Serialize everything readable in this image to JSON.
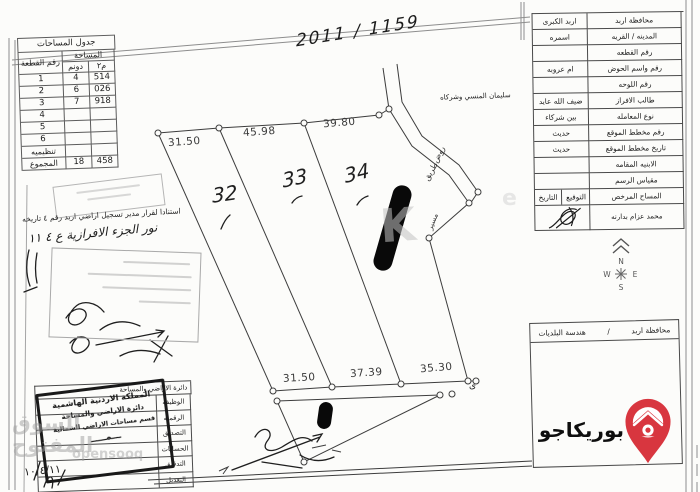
{
  "document": {
    "top_reference_number": "2011 / 1159",
    "overflow_name": "سليمان المنسي وشركاه"
  },
  "area_table": {
    "title": "جدول المساحات",
    "col_plot": "رقم القطعة",
    "col_area": "المساحة",
    "col_dunum": "دونم",
    "col_m2": "م٢",
    "rows": [
      {
        "plot": "1",
        "dunum": "4",
        "m2": "514"
      },
      {
        "plot": "2",
        "dunum": "6",
        "m2": "026"
      },
      {
        "plot": "3",
        "dunum": "7",
        "m2": "918"
      },
      {
        "plot": "4",
        "dunum": "",
        "m2": ""
      },
      {
        "plot": "5",
        "dunum": "",
        "m2": ""
      },
      {
        "plot": "6",
        "dunum": "",
        "m2": ""
      },
      {
        "plot": "تنظيميه",
        "dunum": "",
        "m2": ""
      },
      {
        "plot": "المجموع",
        "dunum": "18",
        "m2": "458"
      }
    ]
  },
  "survey_form": {
    "rows": [
      {
        "label": "محافظة اربد",
        "value": "اربد الكبرى"
      },
      {
        "label": "المدينه / القريه",
        "value": "اسمره"
      },
      {
        "label": "رقم القطعه",
        "value": ""
      },
      {
        "label": "رقم واسم الحوض",
        "value": "ام عروبه"
      },
      {
        "label": "رقم اللوحه",
        "value": ""
      },
      {
        "label": "طالب الافراز",
        "value": "ضيف الله عايد"
      },
      {
        "label": "نوع المعامله",
        "value": "بين شركاء"
      },
      {
        "label": "رقم مخطط الموقع",
        "value": "حديث"
      },
      {
        "label": "تاريخ مخطط الموقع",
        "value": "حديث"
      },
      {
        "label": "الابنيه المقامه",
        "value": ""
      },
      {
        "label": "مقياس الرسم",
        "value": ""
      }
    ],
    "surveyor_row": {
      "label": "المساح المرخص",
      "signature_col": "التوقيع",
      "date_col": "التاريخ"
    },
    "surveyor_name": "محمد عزام بدارنه"
  },
  "map": {
    "top_dimensions": [
      "31.50",
      "45.98",
      "39.80"
    ],
    "bottom_dimensions": [
      "31.50",
      "37.39",
      "35.30"
    ],
    "parcel_numbers": [
      "32",
      "33",
      "34"
    ],
    "road_label_1": "روض",
    "road_label_2": "طريق",
    "road_label_3": "مسير",
    "corner_note": "ى"
  },
  "compass": {
    "north": "N",
    "south": "S",
    "east": "E",
    "west": "W"
  },
  "municipality_box": {
    "right_text": "محافظة اربد",
    "separator": "/",
    "left_text": "هندسة البلديات"
  },
  "left_table": {
    "header": "دائرة الاراضي والمساحة",
    "rows": [
      "الوظيفه",
      "الرقمنه",
      "التصديق",
      "الحسابات",
      "التدقيق",
      "التعديل"
    ]
  },
  "stamp": {
    "lines": [
      "المملكة الاردنية الهاشمية",
      "دائرة الاراضي والمساحة",
      "قسم مساحات الاراضي الشمالية"
    ]
  },
  "handwriting": {
    "note_line_1": "استنادا لقرار مدير تسجيل اراضي اربد رقم ٤ تاريخه",
    "note_line_2": "نور الجزء الافرازية ع ٤ ١١",
    "date_note": "١٠/٤/١١"
  },
  "watermarks": {
    "text_1": "السوق المفتوح",
    "text_2": "opensooq",
    "letter": "K",
    "letter_2": "e"
  },
  "logo": {
    "text": "بوريكاجو",
    "pin_color": "#d8363f"
  }
}
